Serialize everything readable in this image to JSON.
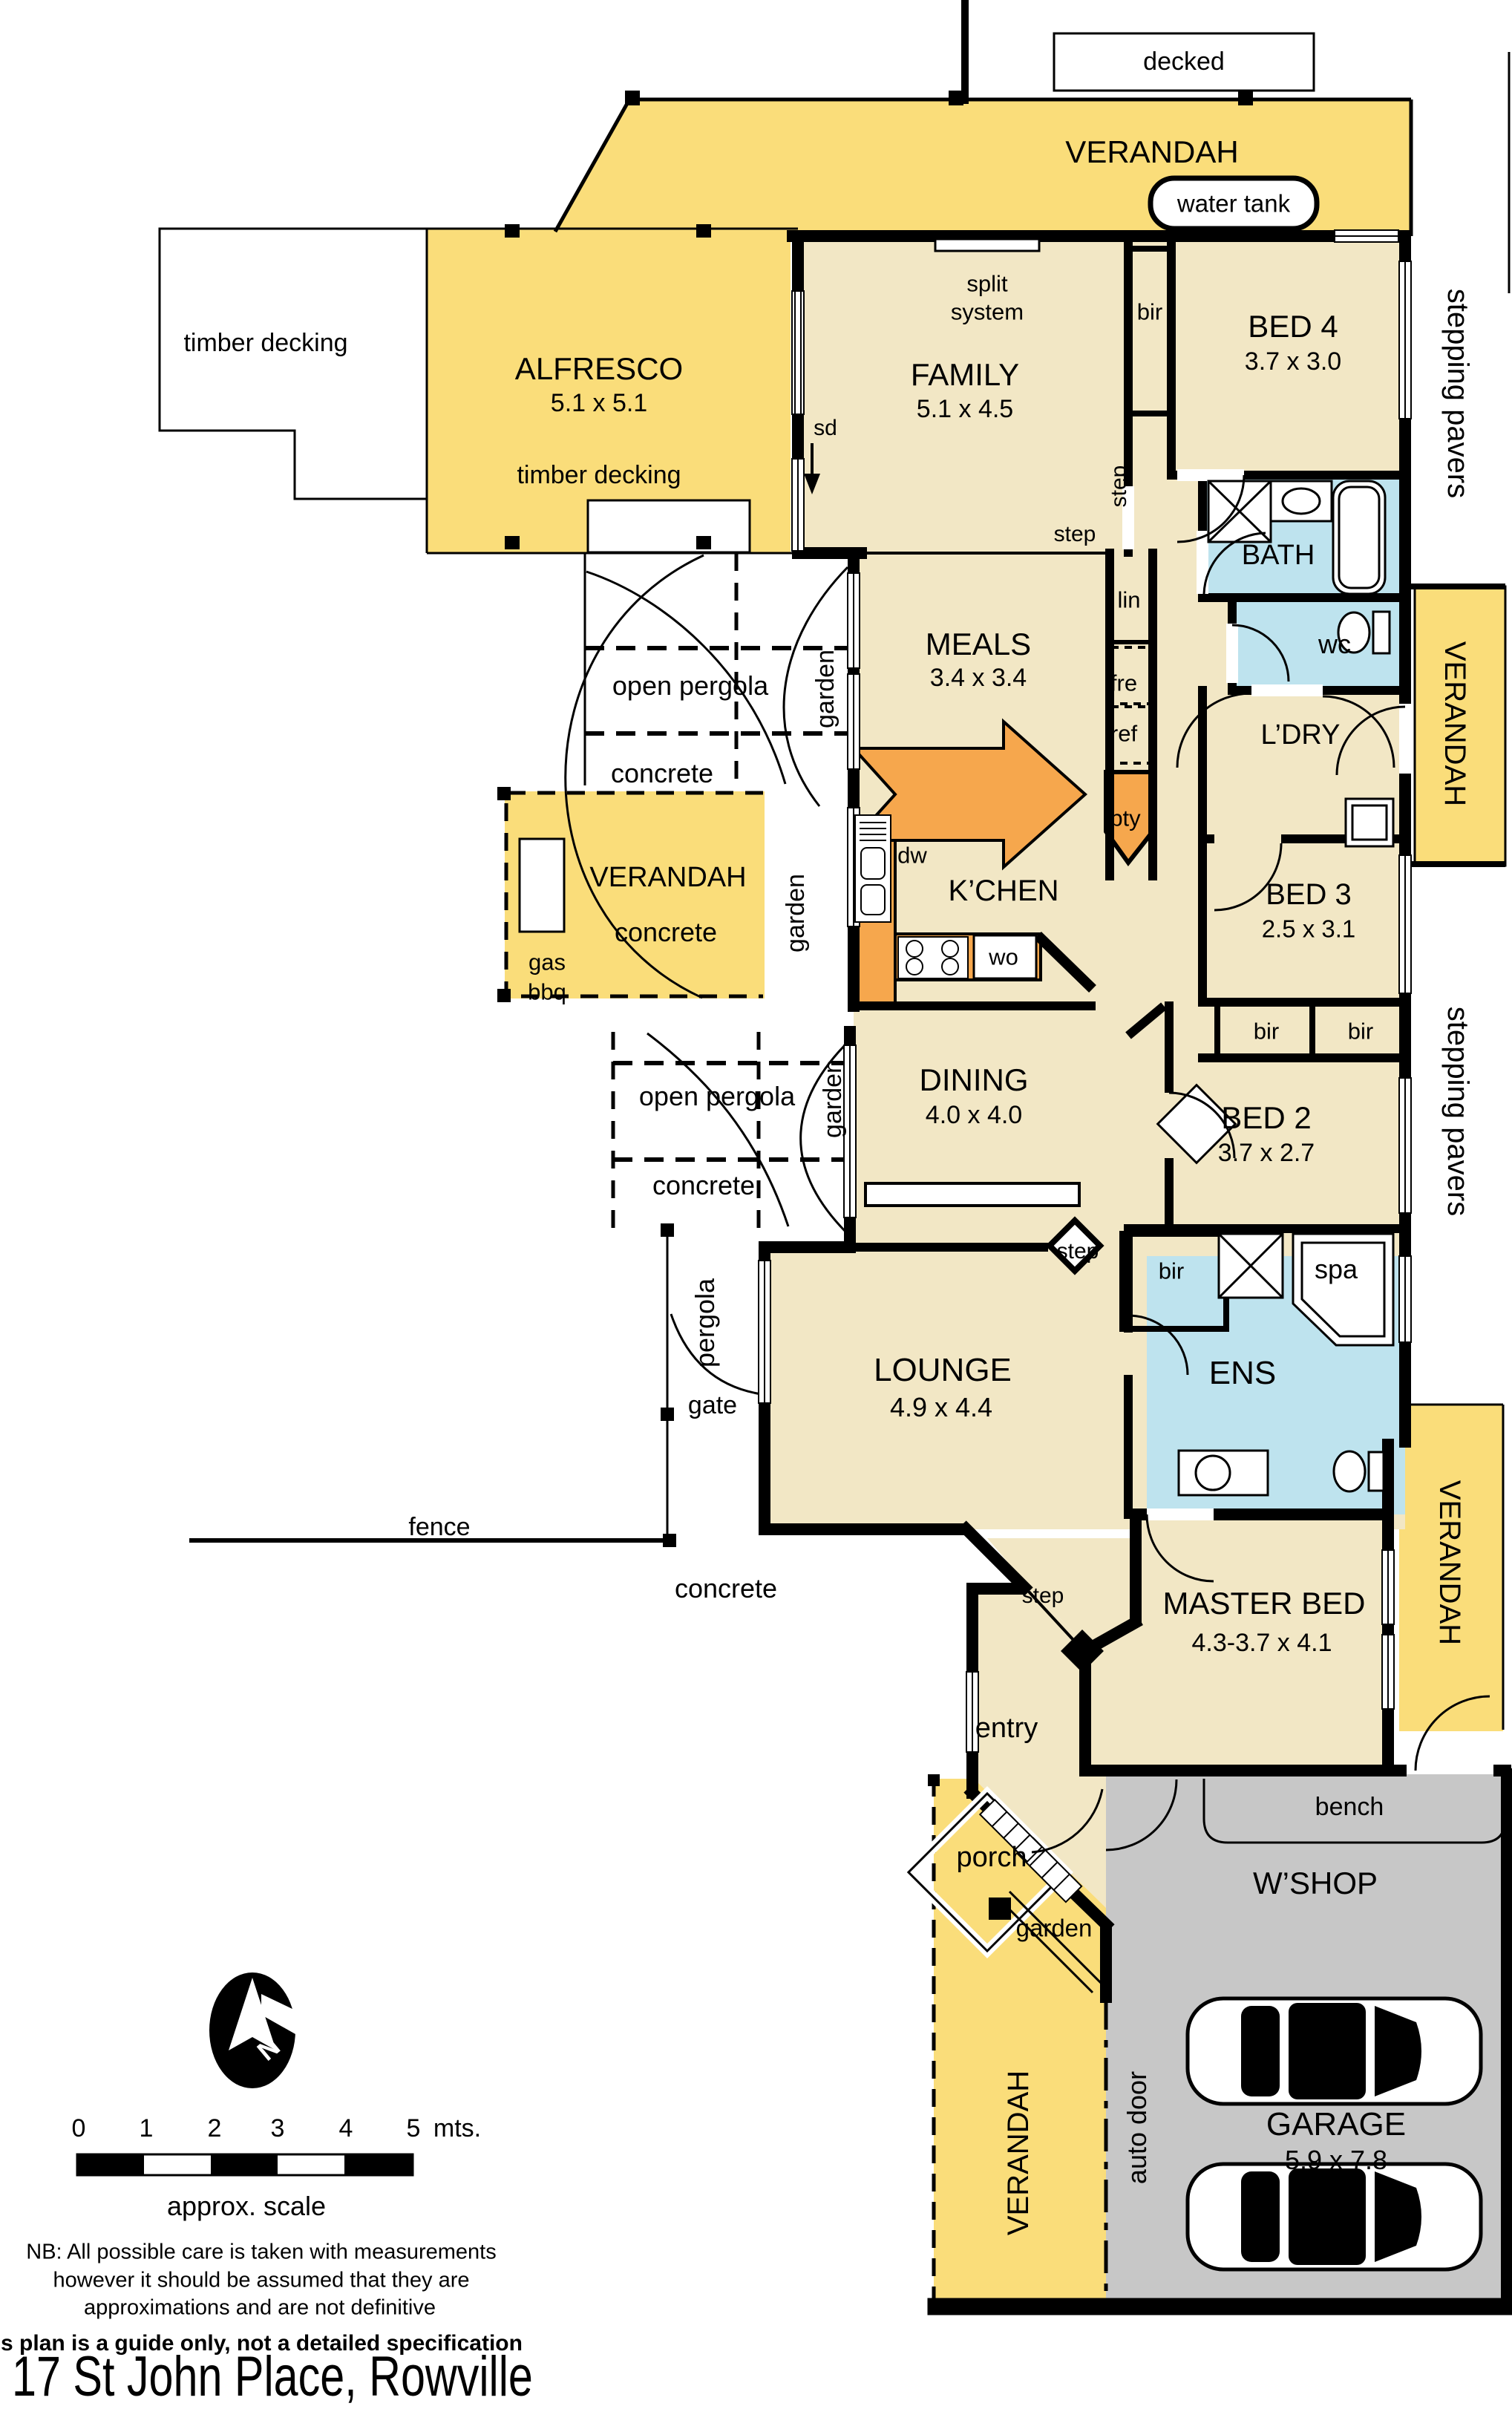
{
  "title": "17 St John Place, Rowville",
  "outdoor": {
    "decked": "decked",
    "verandah_top": "VERANDAH",
    "water_tank": "water tank",
    "timber_decking": "timber decking",
    "alfresco_name": "ALFRESCO",
    "alfresco_dims": "5.1 x 5.1",
    "alfresco_note": "timber decking",
    "open_pergola_1": "open pergola",
    "concrete_1": "concrete",
    "garden_1": "garden",
    "verandah_bbq_name": "VERANDAH",
    "verandah_bbq_note": "concrete",
    "gas": "gas",
    "bbq": "bbq",
    "garden_2": "garden",
    "open_pergola_2": "open pergola",
    "concrete_2": "concrete",
    "garden_3": "garden",
    "pergola": "pergola",
    "gate": "gate",
    "fence": "fence",
    "concrete_3": "concrete",
    "stepping_pavers_1": "stepping pavers",
    "stepping_pavers_2": "stepping pavers",
    "verandah_right_1": "VERANDAH",
    "verandah_right_2": "VERANDAH",
    "verandah_bottom": "VERANDAH",
    "auto_door": "auto door",
    "porch": "porch",
    "garden_4": "garden",
    "entry": "entry",
    "bench": "bench"
  },
  "rooms": {
    "family_name": "FAMILY",
    "family_dims": "5.1 x 4.5",
    "meals_name": "MEALS",
    "meals_dims": "3.4 x 3.4",
    "kitchen_name": "K’CHEN",
    "dining_name": "DINING",
    "dining_dims": "4.0 x 4.0",
    "lounge_name": "LOUNGE",
    "lounge_dims": "4.9 x 4.4",
    "bed4_name": "BED 4",
    "bed4_dims": "3.7 x 3.0",
    "bed3_name": "BED 3",
    "bed3_dims": "2.5 x 3.1",
    "bed2_name": "BED 2",
    "bed2_dims": "3.7 x 2.7",
    "master_name": "MASTER BED",
    "master_dims": "4.3-3.7 x 4.1",
    "bath": "BATH",
    "wc": "wc",
    "ldry": "L’DRY",
    "ens": "ENS",
    "spa": "spa",
    "wshop": "W’SHOP",
    "garage_name": "GARAGE",
    "garage_dims": "5.9 x 7.8"
  },
  "features": {
    "split_1": "split",
    "split_2": "system",
    "sd": "sd",
    "dw": "dw",
    "wo": "wo",
    "pty": "pty",
    "lin": "lin",
    "fre": "fre",
    "ref": "ref",
    "bir_1": "bir",
    "bir_2": "bir",
    "bir_3": "bir",
    "bir_4": "bir",
    "step_1": "step",
    "step_2": "step",
    "step_3": "step",
    "step_4": "step"
  },
  "legend": {
    "north": "N",
    "scale_ticks": [
      "0",
      "1",
      "2",
      "3",
      "4",
      "5"
    ],
    "scale_unit": "mts.",
    "scale_caption": "approx. scale",
    "nb_1": "NB:  All possible care is taken with measurements",
    "nb_2": "however it should be assumed that they are",
    "nb_3": "approximations and are not definitive",
    "disclaimer": "This plan is a guide only, not a detailed specification"
  },
  "colors": {
    "verandah": "#FADD7A",
    "interior": "#F2E7C5",
    "wet_area": "#BEE3EE",
    "bench_counter": "#F6A74D",
    "garage": "#C7C7C7",
    "wall": "#000000"
  }
}
